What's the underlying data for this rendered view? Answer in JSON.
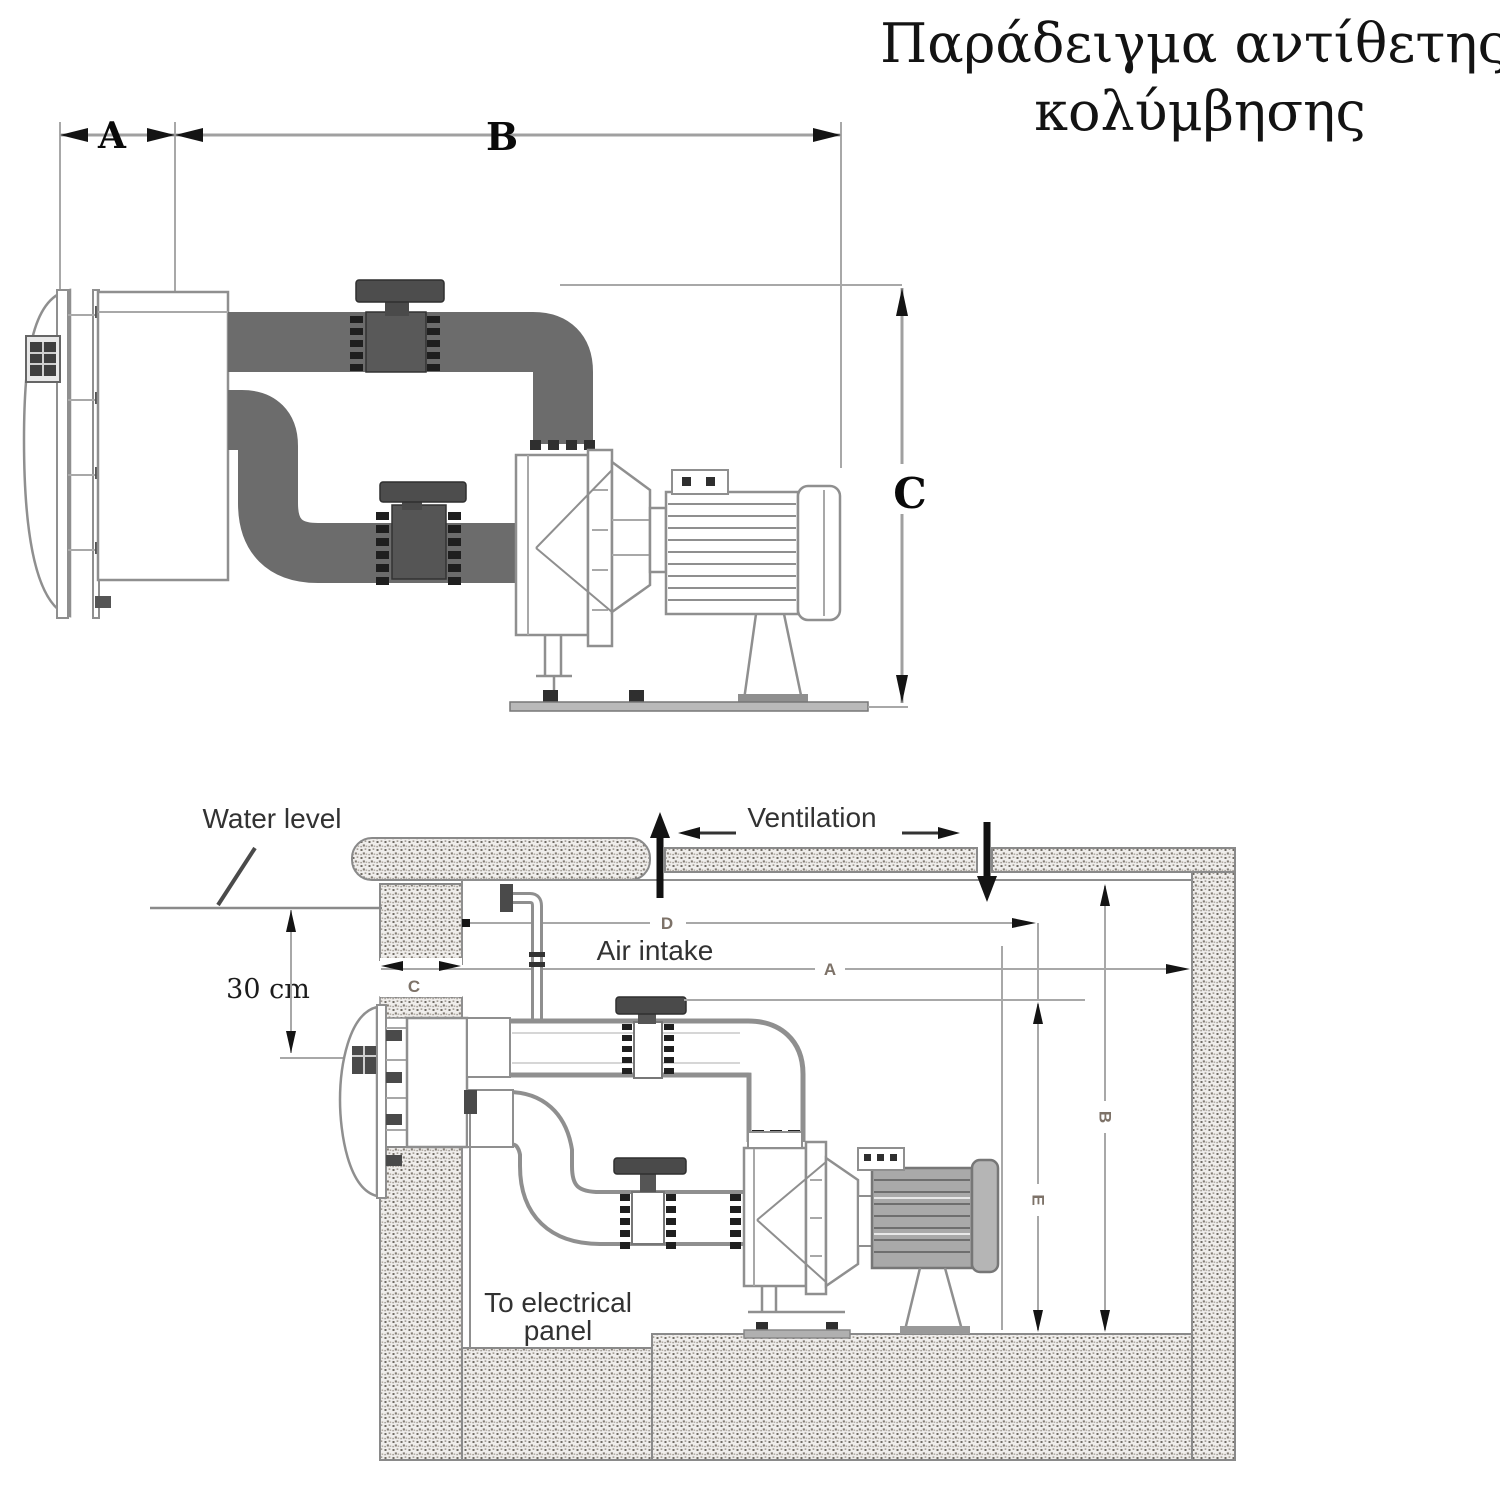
{
  "title": {
    "line1": "Παράδειγμα αντίθετης",
    "line2": "κολύμβησης"
  },
  "top_diagram": {
    "dim_a": "A",
    "dim_b": "B",
    "dim_c": "C"
  },
  "bottom_diagram": {
    "water_level": "Water level",
    "ventilation": "Ventilation",
    "air_intake": "Air intake",
    "offset_depth": "30 cm",
    "electrical_line1": "To electrical",
    "electrical_line2": "panel",
    "dim_d": "D",
    "dim_a": "A",
    "dim_c": "C",
    "dim_e": "E",
    "dim_b": "B"
  },
  "colors": {
    "pipe_dark": "#6c6c6c",
    "valve_dark": "#4a4a4a",
    "outline_gray": "#8f8f8f",
    "dimension_gray": "#a0a0a0",
    "small_dim_label": "#7d7268",
    "arrow_black": "#141414",
    "text_dark": "#323232"
  }
}
